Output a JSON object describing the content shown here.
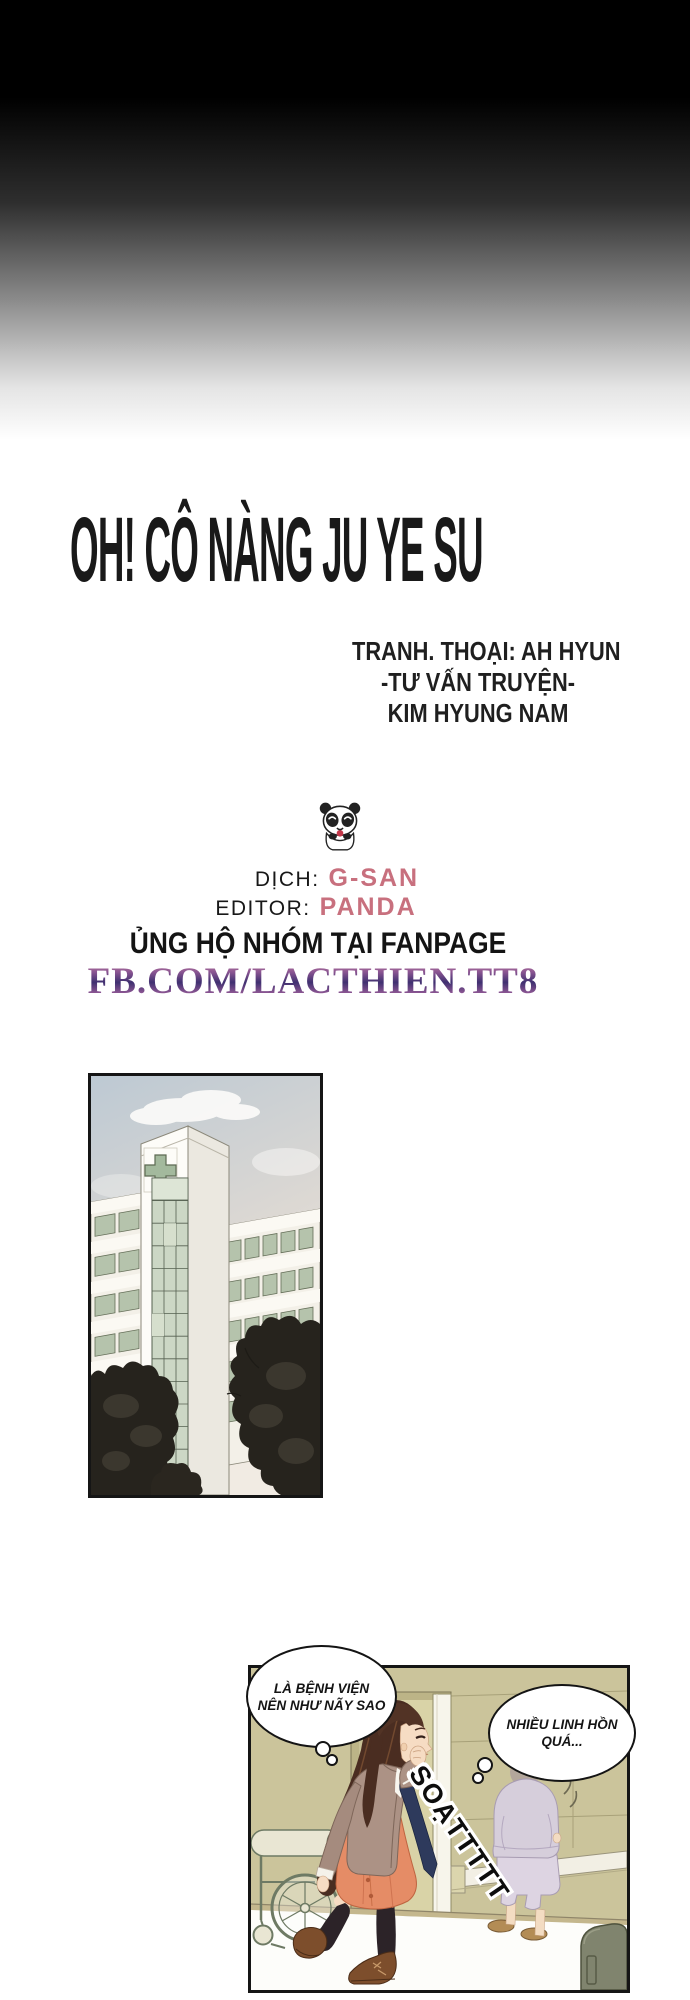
{
  "header": {
    "title": "OH! CÔ NÀNG JU YE SU"
  },
  "credits": {
    "lines": [
      "TRANH. THOẠI: AH HYUN",
      "-TƯ VẤN TRUYỆN-",
      "KIM HYUNG NAM"
    ]
  },
  "team": {
    "panda_icon": "panda-icon",
    "translator_label": "DỊCH:",
    "translator_name": "G-SAN",
    "editor_label": "EDITOR:",
    "editor_name": "PANDA",
    "support_line": "ỦNG HỘ NHÓM TẠI FANPAGE",
    "fanpage": "FB.COM/LACTHIEN.TT8"
  },
  "colors": {
    "accent_pink": "#c8707e",
    "fanpage_purple": "#3f3070",
    "fanpage_pink": "#cf8aa6",
    "wall_olive": "#cbc49b",
    "dress_coral": "#e58c66",
    "pajama_lavender": "#d6cedb",
    "glass_green": "#ccd7c5"
  },
  "comic": {
    "bubble1_line1": "LÀ BỆNH VIỆN",
    "bubble1_line2": "NÊN NHƯ NÃY SAO",
    "bubble2_line1": "NHIỀU LINH HỒN",
    "bubble2_line2": "QUÁ...",
    "sfx": "SOẠTTTTT"
  }
}
